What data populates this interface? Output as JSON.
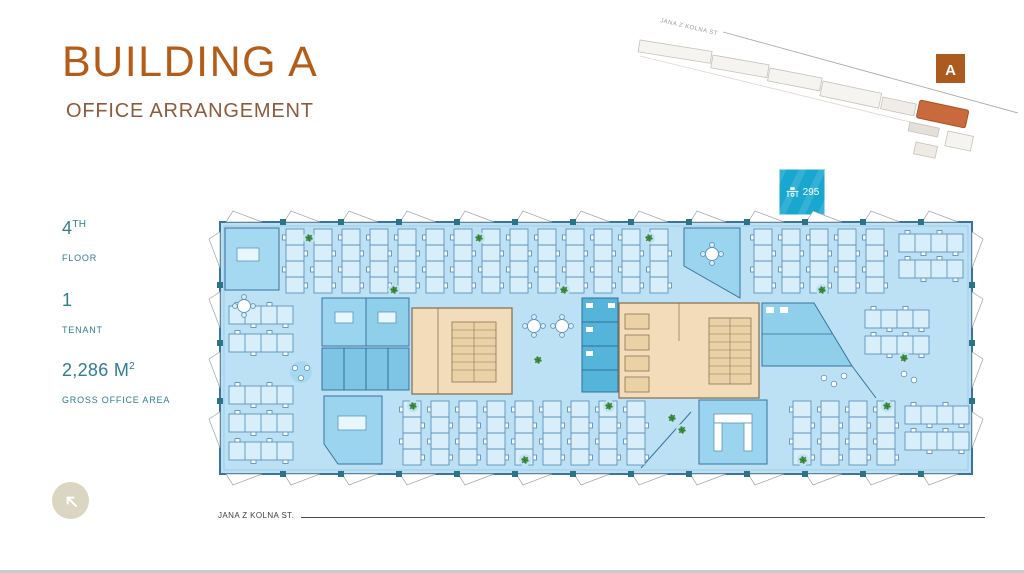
{
  "slide": {
    "title": "BUILDING A",
    "subtitle": "OFFICE ARRANGEMENT"
  },
  "stats": [
    {
      "value": "4",
      "sup": "TH",
      "label": "FLOOR"
    },
    {
      "value": "1",
      "sup": "",
      "label": "TENANT"
    },
    {
      "value": "2,286 M",
      "sup": "2",
      "label": "GROSS OFFICE AREA"
    }
  ],
  "badge": {
    "count": "295",
    "icon": "desk-icon",
    "color": "#17A7CF"
  },
  "minimap": {
    "street_label": "JANA Z KOLNA ST",
    "building_label": "A",
    "highlight_color": "#C96A3C"
  },
  "street": {
    "label": "JANA Z KOLNA ST."
  },
  "icons": {
    "badge": "desk-icon",
    "back": "arrow-up-left-icon"
  },
  "colors": {
    "title": "#B45C18",
    "subtitle": "#8D5B3B",
    "stat_teal": "#2E7E8F",
    "plan_floor": "#BCE1F5",
    "room_blue": "#9AD4EE",
    "utility_blue": "#55B4DA",
    "core_beige": "#F3DCBA",
    "marker_orange": "#AD5A1E"
  }
}
